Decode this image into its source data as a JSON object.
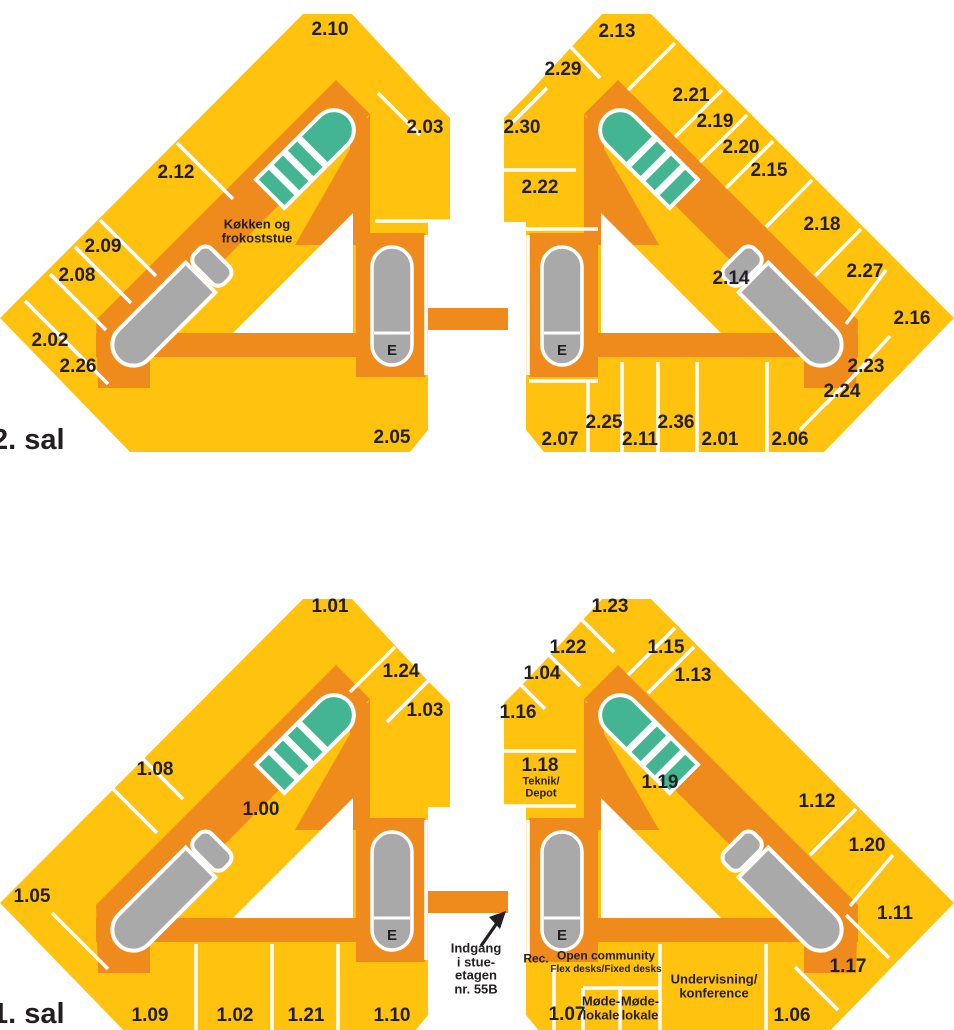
{
  "title": "Floor plan 1. sal / 2. sal",
  "colors": {
    "room_yellow": "#FFC20E",
    "corridor_orange": "#EF8A1D",
    "stairs_green": "#44B592",
    "elevator_gray": "#A9A9AA",
    "label_dark": "#231F20",
    "background": "#FFFFFF"
  },
  "floors": [
    {
      "name": "2. sal",
      "labels": [
        {
          "text": "2. sal",
          "kind": "floor",
          "x": -8,
          "y": 440
        },
        {
          "text": "2.10",
          "x": 330,
          "y": 30
        },
        {
          "text": "2.03",
          "x": 425,
          "y": 128
        },
        {
          "text": "2.12",
          "x": 176,
          "y": 173
        },
        {
          "text": "Køkken og\nfrokoststue",
          "kind": "note",
          "x": 257,
          "y": 231
        },
        {
          "text": "2.09",
          "x": 103,
          "y": 247
        },
        {
          "text": "2.08",
          "x": 77,
          "y": 276
        },
        {
          "text": "2.02",
          "x": 50,
          "y": 341
        },
        {
          "text": "2.26",
          "x": 78,
          "y": 367
        },
        {
          "text": "2.05",
          "x": 392,
          "y": 438
        },
        {
          "text": "E",
          "kind": "elev",
          "x": 392,
          "y": 351
        },
        {
          "text": "2.13",
          "x": 617,
          "y": 32
        },
        {
          "text": "2.29",
          "x": 563,
          "y": 70
        },
        {
          "text": "2.30",
          "x": 522,
          "y": 128
        },
        {
          "text": "2.21",
          "x": 691,
          "y": 96
        },
        {
          "text": "2.19",
          "x": 715,
          "y": 122
        },
        {
          "text": "2.20",
          "x": 741,
          "y": 148
        },
        {
          "text": "2.15",
          "x": 769,
          "y": 171
        },
        {
          "text": "2.22",
          "x": 540,
          "y": 188
        },
        {
          "text": "2.18",
          "x": 822,
          "y": 225
        },
        {
          "text": "2.14",
          "x": 731,
          "y": 279
        },
        {
          "text": "2.27",
          "x": 865,
          "y": 272
        },
        {
          "text": "2.16",
          "x": 912,
          "y": 319
        },
        {
          "text": "2.23",
          "x": 866,
          "y": 367
        },
        {
          "text": "2.24",
          "x": 842,
          "y": 392
        },
        {
          "text": "2.07",
          "x": 560,
          "y": 440
        },
        {
          "text": "2.25",
          "x": 604,
          "y": 423
        },
        {
          "text": "2.11",
          "x": 640,
          "y": 440
        },
        {
          "text": "2.36",
          "x": 676,
          "y": 423
        },
        {
          "text": "2.01",
          "x": 720,
          "y": 440
        },
        {
          "text": "2.06",
          "x": 790,
          "y": 440
        },
        {
          "text": "E",
          "kind": "elev",
          "x": 562,
          "y": 351
        }
      ]
    },
    {
      "name": "1. sal",
      "labels": [
        {
          "text": "1. sal",
          "kind": "floor",
          "x": -8,
          "y": 1014
        },
        {
          "text": "1.01",
          "x": 330,
          "y": 607
        },
        {
          "text": "1.24",
          "x": 401,
          "y": 672
        },
        {
          "text": "1.03",
          "x": 425,
          "y": 711
        },
        {
          "text": "1.08",
          "x": 155,
          "y": 770
        },
        {
          "text": "1.00",
          "x": 261,
          "y": 810
        },
        {
          "text": "1.05",
          "x": 32,
          "y": 897
        },
        {
          "text": "1.09",
          "x": 150,
          "y": 1016
        },
        {
          "text": "1.02",
          "x": 235,
          "y": 1016
        },
        {
          "text": "1.21",
          "x": 306,
          "y": 1016
        },
        {
          "text": "1.10",
          "x": 392,
          "y": 1016
        },
        {
          "text": "E",
          "kind": "elev",
          "x": 392,
          "y": 936
        },
        {
          "text": "Indgang\ni stue-\netagen\nnr. 55B",
          "kind": "note",
          "x": 476,
          "y": 969
        },
        {
          "text": "1.23",
          "x": 610,
          "y": 607
        },
        {
          "text": "1.22",
          "x": 568,
          "y": 648
        },
        {
          "text": "1.04",
          "x": 542,
          "y": 674
        },
        {
          "text": "1.15",
          "x": 666,
          "y": 648
        },
        {
          "text": "1.13",
          "x": 693,
          "y": 676
        },
        {
          "text": "1.16",
          "x": 518,
          "y": 713
        },
        {
          "text": "1.18",
          "x": 540,
          "y": 766
        },
        {
          "text": "Teknik/\nDepot",
          "kind": "note",
          "fs": 11,
          "x": 541,
          "y": 788
        },
        {
          "text": "1.19",
          "x": 660,
          "y": 783
        },
        {
          "text": "1.12",
          "x": 817,
          "y": 802
        },
        {
          "text": "1.20",
          "x": 867,
          "y": 846
        },
        {
          "text": "1.11",
          "x": 895,
          "y": 914
        },
        {
          "text": "1.17",
          "x": 848,
          "y": 967
        },
        {
          "text": "Rec.",
          "kind": "note",
          "fs": 12,
          "x": 536,
          "y": 959
        },
        {
          "text": "Open community",
          "kind": "note",
          "fs": 12,
          "x": 606,
          "y": 956
        },
        {
          "text": "Flex desks/Fixed desks",
          "kind": "note",
          "fs": 10,
          "x": 606,
          "y": 970
        },
        {
          "text": "Møde-\nlokale",
          "kind": "note",
          "fs": 13,
          "x": 601,
          "y": 1008
        },
        {
          "text": "Møde-\nlokale",
          "kind": "note",
          "fs": 13,
          "x": 640,
          "y": 1008
        },
        {
          "text": "Undervisning/\nkonference",
          "kind": "note",
          "fs": 13,
          "x": 714,
          "y": 986
        },
        {
          "text": "1.07",
          "x": 567,
          "y": 1015
        },
        {
          "text": "1.06",
          "x": 792,
          "y": 1016
        },
        {
          "text": "E",
          "kind": "elev",
          "x": 562,
          "y": 936
        }
      ]
    }
  ]
}
